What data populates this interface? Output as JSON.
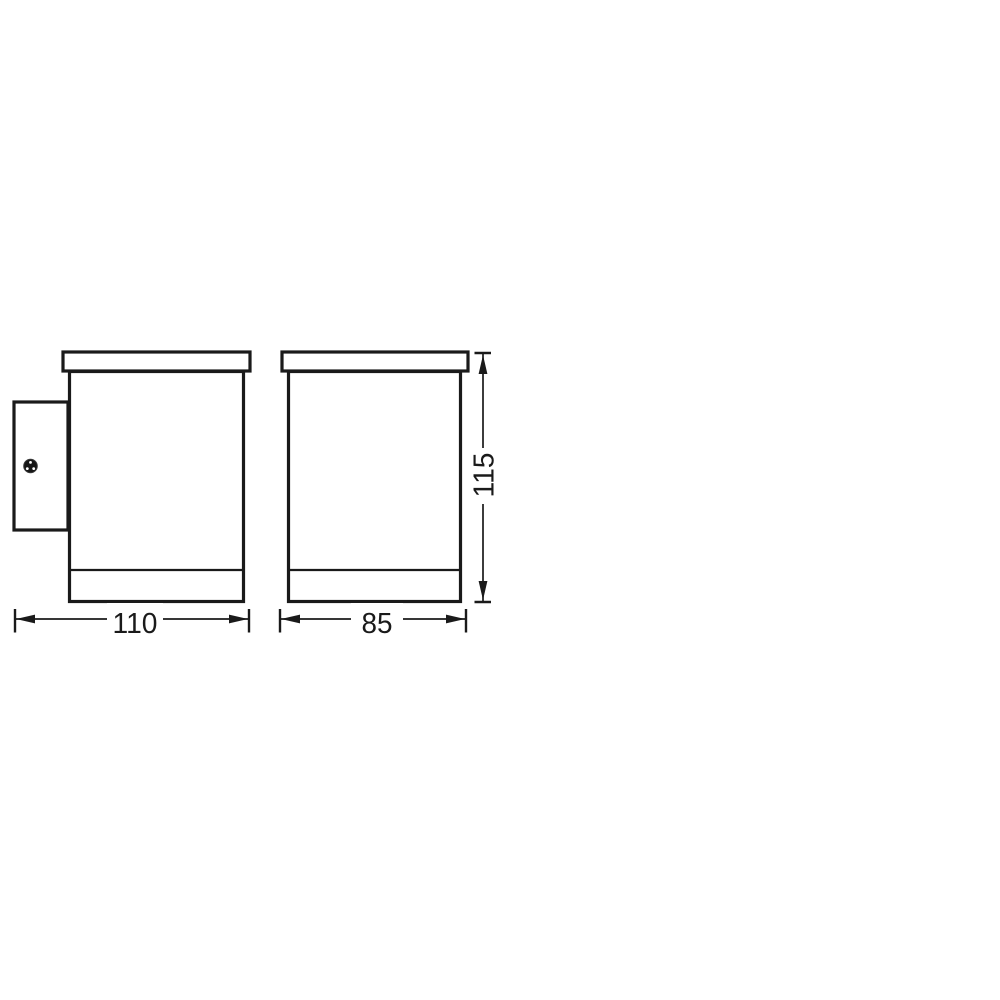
{
  "drawing": {
    "background_color": "#ffffff",
    "line_color": "#1a1a1a",
    "dimension_labels": {
      "depth": "110",
      "width": "85",
      "height": "115"
    }
  }
}
